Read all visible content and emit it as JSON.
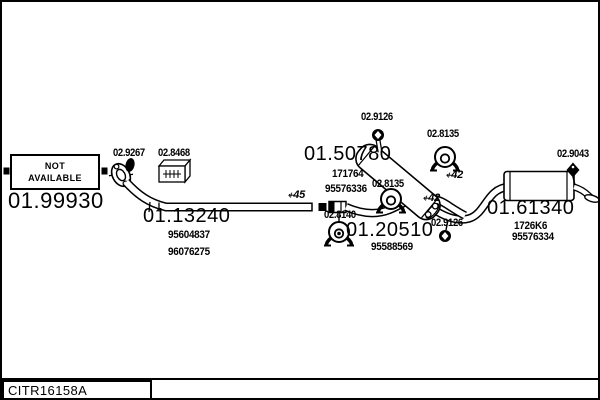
{
  "colors": {
    "ink": "#000000",
    "paper": "#ffffff"
  },
  "diagram": {
    "footer_code": "CITR16158A",
    "not_available": {
      "line1": "NOT",
      "line2": "AVAILABLE",
      "code": "01.99930"
    },
    "front_pipe": {
      "code": "01.13240",
      "oem": [
        "95604837",
        "96076275"
      ],
      "diameter": "⍅45"
    },
    "center_muffler": {
      "code": "01.50780",
      "oem": [
        "171764",
        "95576336"
      ]
    },
    "center_pipe": {
      "code": "01.20510",
      "oem": [
        "95588569"
      ]
    },
    "rear_muffler": {
      "code": "01.61340",
      "oem": [
        "1726K6",
        "95576334"
      ],
      "diameter_notes": [
        "⍅42",
        "⍅42"
      ]
    },
    "fittings": {
      "flange_gasket": "02.9267",
      "fitting_kit": "02.8468",
      "clamp_top": "02.9126",
      "clamp_right": "02.9126",
      "hanger_upper": "02.8135",
      "hanger_lower": "02.8135",
      "hanger_center": "02.8140",
      "tail_mount": "02.9043"
    }
  }
}
